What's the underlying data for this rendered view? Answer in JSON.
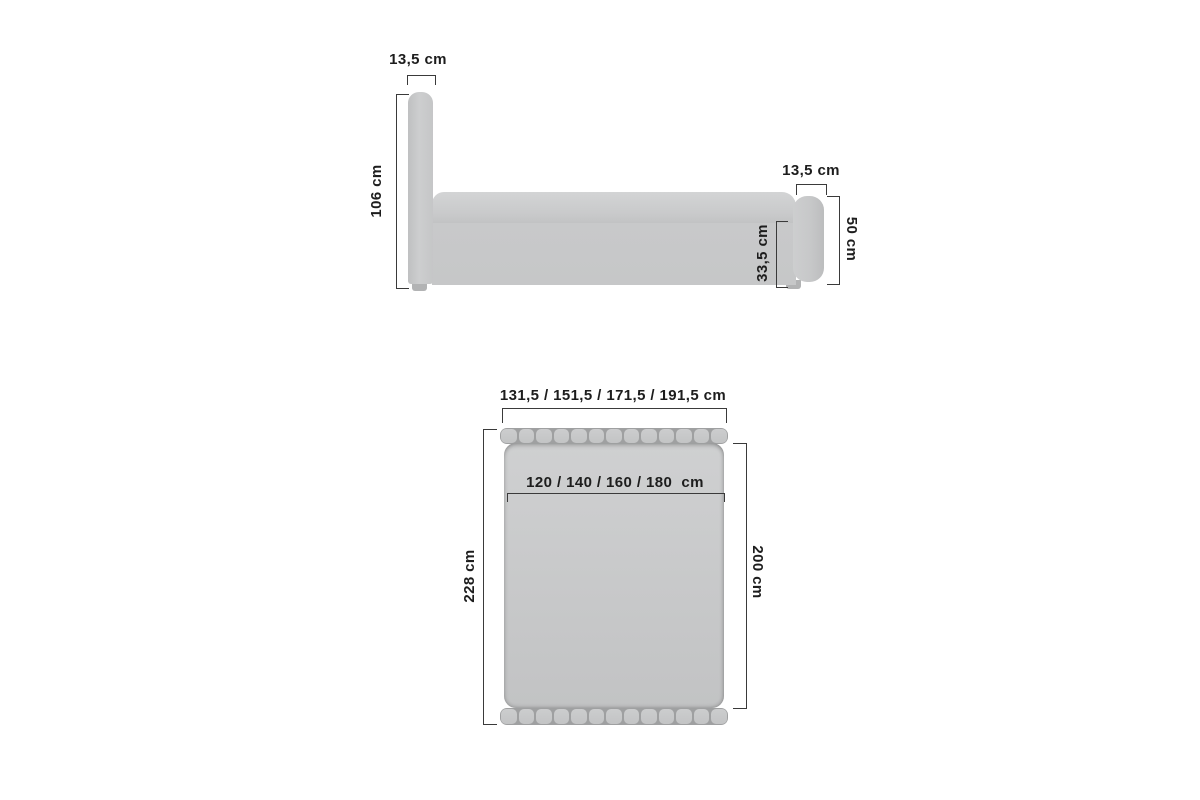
{
  "diagram": {
    "title": "bed-dimension-diagram",
    "side_view": {
      "headboard_width_label": "13,5 cm",
      "headboard_height_label": "106 cm",
      "footboard_width_label": "13,5 cm",
      "base_height_label": "33,5 cm",
      "footboard_height_label": "50 cm"
    },
    "top_view": {
      "overall_width_label": "131,5 / 151,5 / 171,5 / 191,5 cm",
      "mattress_width_label": "120 / 140 / 160 / 180  cm",
      "overall_length_label": "228 cm",
      "mattress_length_label": "200 cm",
      "headboard_slat_count": 13,
      "footboard_slat_count": 13
    },
    "colors": {
      "line": "#3a3a3a",
      "text": "#1d1d1d",
      "background": "#ffffff",
      "bed_fill": "#c9cacb",
      "bed_fill_light": "#d2d3d4",
      "bed_fill_dark": "#bfc0c1",
      "slat_gap": "#9fa0a1",
      "foot": "#b2b3b4",
      "edge": "#b7b8b9"
    }
  }
}
